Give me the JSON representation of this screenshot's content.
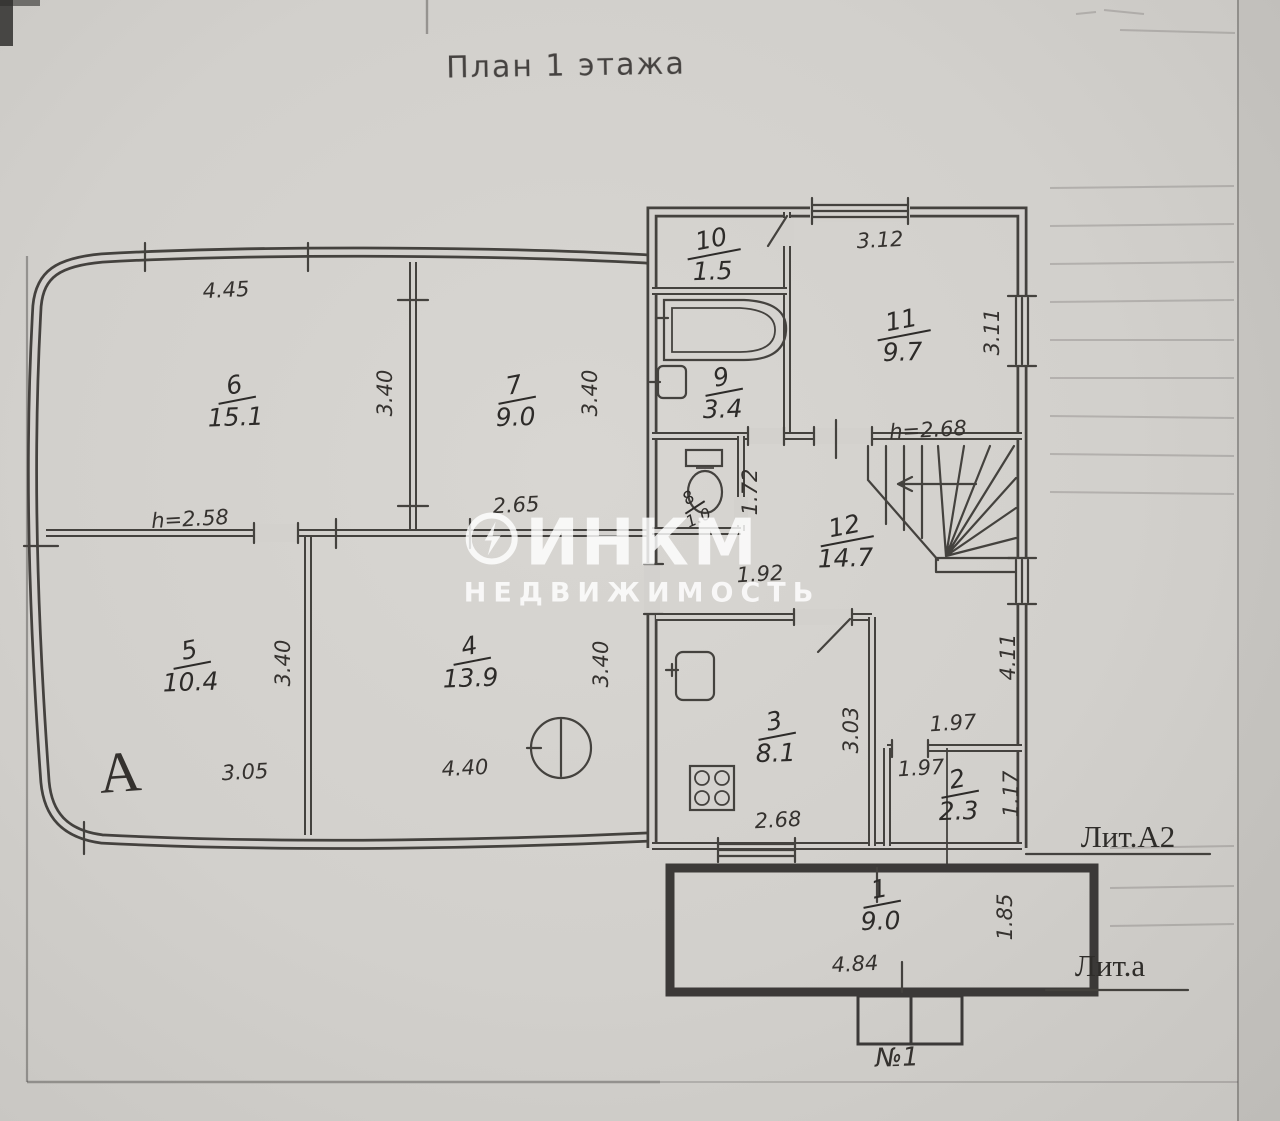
{
  "title": "План 1 этажа",
  "watermark": {
    "brand_prefix": "ИНК",
    "brand_suffix": "М",
    "subtitle": "НЕДВИЖИМОСТЬ"
  },
  "marks": {
    "lit_a2": "Лит.А2",
    "lit_a": "Лит.а",
    "porch": "№1",
    "building_letter": "А"
  },
  "rooms": [
    {
      "number": "1",
      "area": "9.0"
    },
    {
      "number": "2",
      "area": "2.3"
    },
    {
      "number": "3",
      "area": "8.1"
    },
    {
      "number": "4",
      "area": "13.9"
    },
    {
      "number": "5",
      "area": "10.4"
    },
    {
      "number": "6",
      "area": "15.1"
    },
    {
      "number": "7",
      "area": "9.0"
    },
    {
      "number": "8",
      "area": "1.0"
    },
    {
      "number": "9",
      "area": "3.4"
    },
    {
      "number": "10",
      "area": "1.5"
    },
    {
      "number": "11",
      "area": "9.7"
    },
    {
      "number": "12",
      "area": "14.7"
    }
  ],
  "dims": {
    "room6_top": "4.45",
    "room6_right": "3.40",
    "room6_height": "h=2.58",
    "room7_right": "3.40",
    "room7_bottom": "2.65",
    "room5_right": "3.40",
    "room5_bottom": "3.05",
    "room4_right": "3.40",
    "room4_bottom": "4.40",
    "sec2_top": "3.12",
    "room11_right": "3.11",
    "hall_height": "h=2.68",
    "wc_side": "1.72",
    "hall_left": "1.92",
    "hall_right": "4.11",
    "room2_above": "1.97",
    "room2_inner": "1.97",
    "room2_right": "1.17",
    "room3_right": "3.03",
    "room3_bottom": "2.68",
    "room1_right": "1.85",
    "room1_bottom": "4.84"
  },
  "colors": {
    "paper": "#d2d0cc",
    "ink": "#34312e",
    "watermark": "#ffffff"
  }
}
